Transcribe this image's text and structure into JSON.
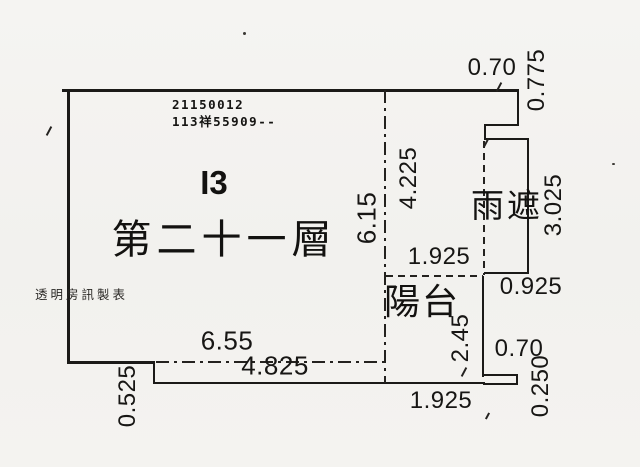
{
  "colors": {
    "background": "#f3f2ef",
    "line": "#1b1a18",
    "text": "#151412"
  },
  "plan": {
    "doc_number_line1": "21150012",
    "doc_number_line2": "113祥55909--",
    "unit_label": "I3",
    "floor_label": "第二十一層",
    "canopy_label": "雨遮",
    "balcony_label": "陽台",
    "stamp_note": "透明房訊製表",
    "dimensions": {
      "top_notch_width": "0.70",
      "top_notch_height": "0.775",
      "upper_right_height": "4.225",
      "main_right_height": "6.15",
      "canopy_height": "3.025",
      "balcony_width": "1.925",
      "canopy_bottom_width": "0.925",
      "balcony_height": "2.45",
      "main_bottom_width": "6.55",
      "lower_boundary_width": "4.825",
      "bottom_step_height": "0.525",
      "bottom_ledge_width": "0.70",
      "bottom_ledge_height": "0.250",
      "bottom_width": "1.925"
    }
  }
}
